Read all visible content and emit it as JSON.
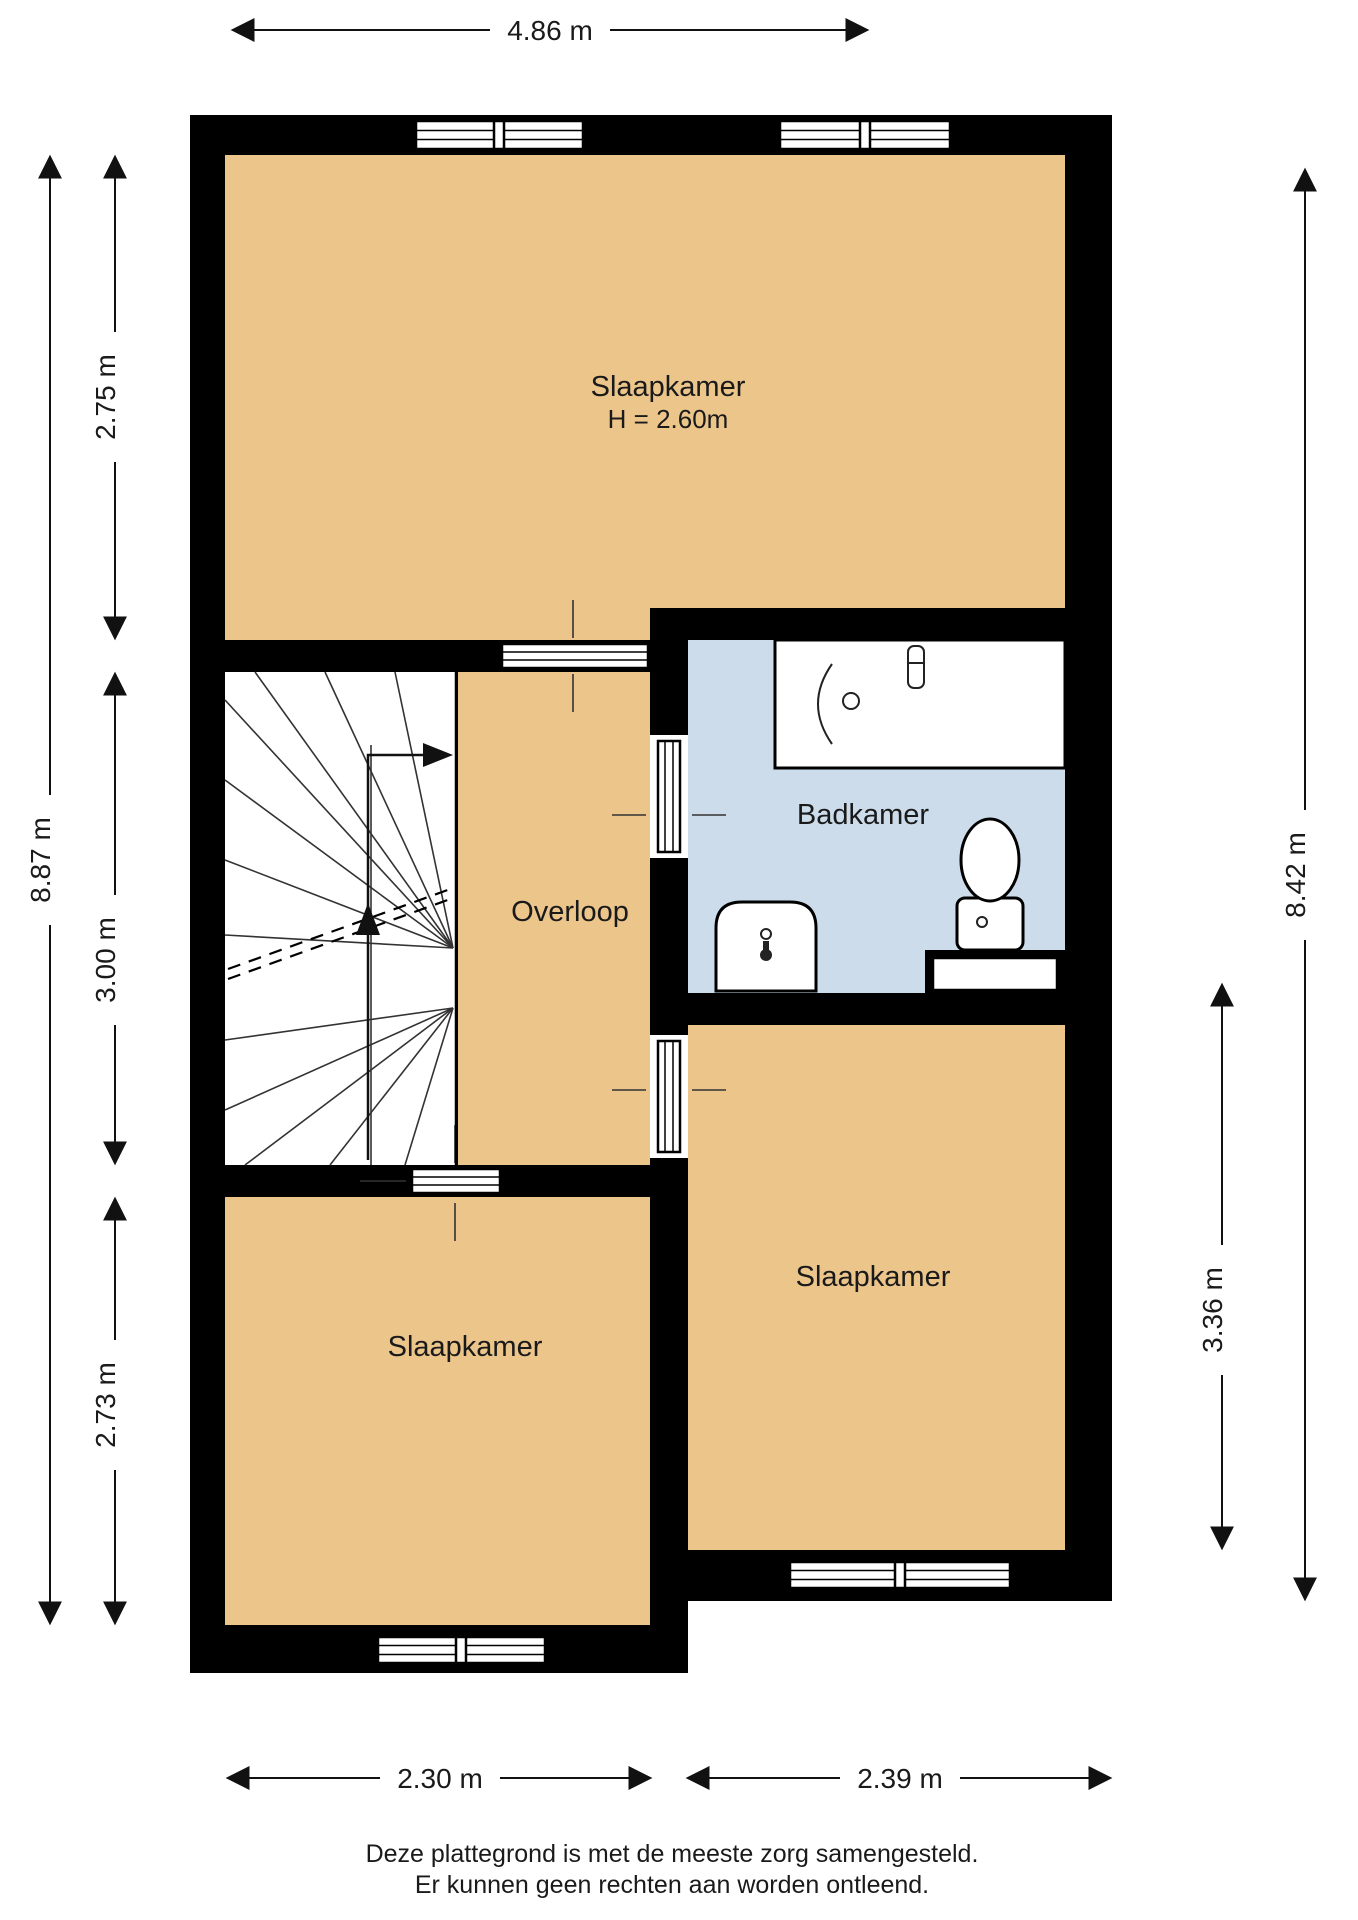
{
  "plan": {
    "rooms": {
      "bedroom_top": {
        "label": "Slaapkamer",
        "height_note": "H = 2.60m"
      },
      "landing": {
        "label": "Overloop"
      },
      "bathroom": {
        "label": "Badkamer"
      },
      "bedroom_left": {
        "label": "Slaapkamer"
      },
      "bedroom_right": {
        "label": "Slaapkamer"
      }
    },
    "dimensions": {
      "top_width": "4.86 m",
      "left_total_height": "8.87 m",
      "left_top": "2.75 m",
      "left_middle": "3.00 m",
      "left_bottom": "2.73 m",
      "right_total_height": "8.42 m",
      "right_bedroom_height": "3.36 m",
      "bottom_left_width": "2.30 m",
      "bottom_right_width": "2.39 m"
    },
    "footer": {
      "line1": "Deze plattegrond is met de meeste zorg samengesteld.",
      "line2": "Er kunnen geen rechten aan worden ontleend."
    },
    "colors": {
      "room_fill": "#ecc58b",
      "bathroom_fill": "#ccdcea",
      "wall": "#000000",
      "background": "#ffffff"
    }
  }
}
